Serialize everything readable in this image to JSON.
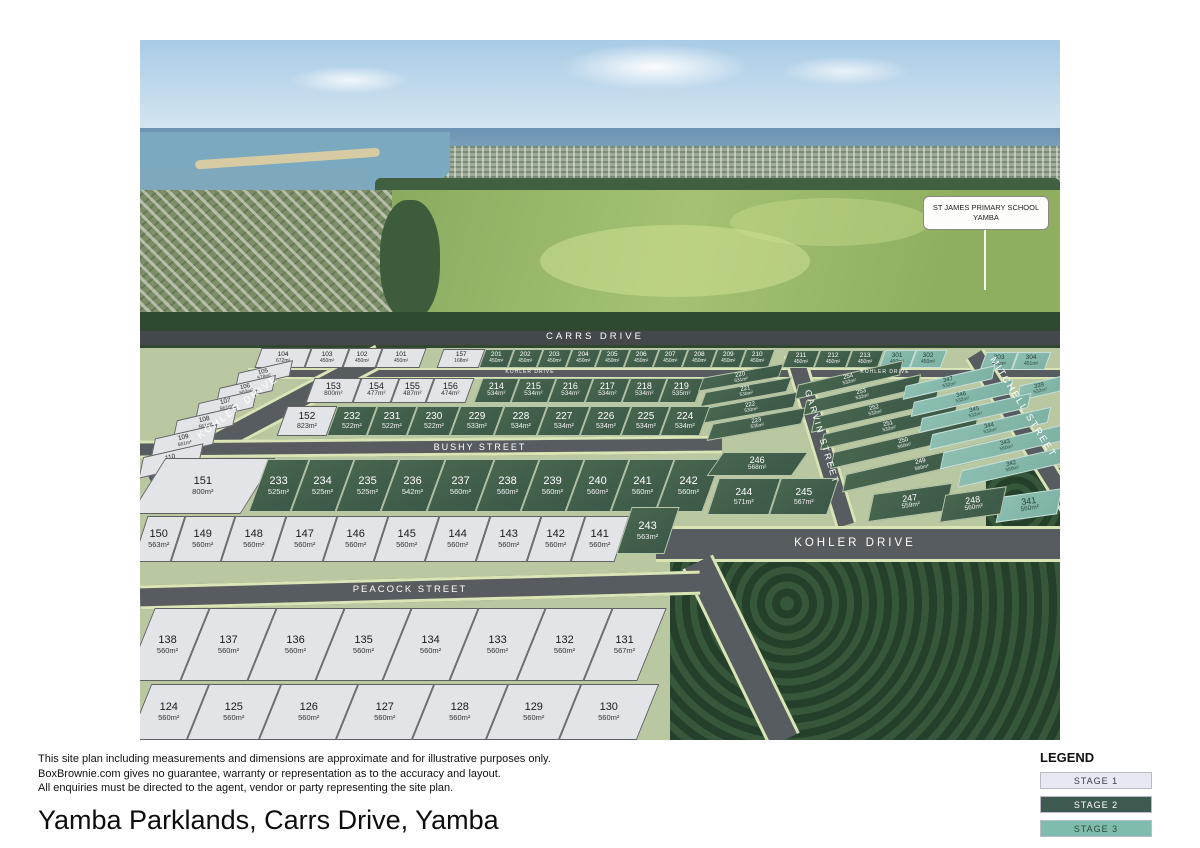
{
  "page": {
    "title": "Yamba Parklands, Carrs Drive, Yamba",
    "disclaimer": [
      "This site plan including measurements and dimensions are approximate and for illustrative purposes only.",
      "BoxBrownie.com gives no guarantee, warranty or representation as to the accuracy and layout.",
      "All enquiries must be directed to the agent, vendor or party representing the site plan."
    ]
  },
  "sign": {
    "line1": "ST JAMES PRIMARY SCHOOL",
    "line2": "YAMBA"
  },
  "streets": {
    "carrs": "CARRS DRIVE",
    "kohler_small_1": "KOHLER DRIVE",
    "kohler_small_2": "KOHLER DRIVE",
    "kohler_left": "KOHLER DRIVE",
    "kohler_main": "KOHLER DRIVE",
    "bushy": "BUSHY STREET",
    "peacock": "PEACOCK STREET",
    "garvin": "GARVIN STREET",
    "mitchell": "MITCHELL STREET"
  },
  "legend": {
    "title": "LEGEND",
    "items": [
      {
        "label": "STAGE 1",
        "color": "#e7e8f1",
        "text_color": "#3c3c44"
      },
      {
        "label": "STAGE 2",
        "color": "#3e5a50",
        "text_color": "#ffffff"
      },
      {
        "label": "STAGE 3",
        "color": "#7fbcae",
        "text_color": "#2c4a42"
      }
    ]
  },
  "stage_colors": {
    "stage1": "#e3e4e8",
    "stage2": "#42604e",
    "stage3": "#85b9ac"
  },
  "lots": [
    {
      "n": "104",
      "a": "672m²",
      "s": 1
    },
    {
      "n": "103",
      "a": "450m²",
      "s": 1
    },
    {
      "n": "102",
      "a": "450m²",
      "s": 1
    },
    {
      "n": "101",
      "a": "450m²",
      "s": 1
    },
    {
      "n": "157",
      "a": "168m²",
      "s": 1
    },
    {
      "n": "201",
      "a": "450m²",
      "s": 2
    },
    {
      "n": "202",
      "a": "450m²",
      "s": 2
    },
    {
      "n": "203",
      "a": "450m²",
      "s": 2
    },
    {
      "n": "204",
      "a": "450m²",
      "s": 2
    },
    {
      "n": "205",
      "a": "450m²",
      "s": 2
    },
    {
      "n": "206",
      "a": "450m²",
      "s": 2
    },
    {
      "n": "207",
      "a": "450m²",
      "s": 2
    },
    {
      "n": "208",
      "a": "450m²",
      "s": 2
    },
    {
      "n": "209",
      "a": "450m²",
      "s": 2
    },
    {
      "n": "210",
      "a": "450m²",
      "s": 2
    },
    {
      "n": "211",
      "a": "450m²",
      "s": 2
    },
    {
      "n": "212",
      "a": "450m²",
      "s": 2
    },
    {
      "n": "213",
      "a": "450m²",
      "s": 2
    },
    {
      "n": "301",
      "a": "450m²",
      "s": 3
    },
    {
      "n": "302",
      "a": "450m²",
      "s": 3
    },
    {
      "n": "303",
      "a": "451m²",
      "s": 3
    },
    {
      "n": "304",
      "a": "451m²",
      "s": 3
    },
    {
      "n": "339",
      "a": "532m²",
      "s": 3
    },
    {
      "n": "105",
      "a": "578m²",
      "s": 1
    },
    {
      "n": "106",
      "a": "563m²",
      "s": 1
    },
    {
      "n": "107",
      "a": "561m²",
      "s": 1
    },
    {
      "n": "108",
      "a": "561m²",
      "s": 1
    },
    {
      "n": "109",
      "a": "561m²",
      "s": 1
    },
    {
      "n": "110",
      "a": "561m²",
      "s": 1
    },
    {
      "n": "153",
      "a": "800m²",
      "s": 1
    },
    {
      "n": "154",
      "a": "477m²",
      "s": 1
    },
    {
      "n": "155",
      "a": "487m²",
      "s": 1
    },
    {
      "n": "156",
      "a": "474m²",
      "s": 1
    },
    {
      "n": "214",
      "a": "534m²",
      "s": 2
    },
    {
      "n": "215",
      "a": "534m²",
      "s": 2
    },
    {
      "n": "216",
      "a": "534m²",
      "s": 2
    },
    {
      "n": "217",
      "a": "534m²",
      "s": 2
    },
    {
      "n": "218",
      "a": "534m²",
      "s": 2
    },
    {
      "n": "219",
      "a": "535m²",
      "s": 2
    },
    {
      "n": "220",
      "a": "631m²",
      "s": 2
    },
    {
      "n": "221",
      "a": "530m²",
      "s": 2
    },
    {
      "n": "222",
      "a": "530m²",
      "s": 2
    },
    {
      "n": "223",
      "a": "535m²",
      "s": 2
    },
    {
      "n": "152",
      "a": "823m²",
      "s": 1
    },
    {
      "n": "232",
      "a": "522m²",
      "s": 2
    },
    {
      "n": "231",
      "a": "522m²",
      "s": 2
    },
    {
      "n": "230",
      "a": "522m²",
      "s": 2
    },
    {
      "n": "229",
      "a": "533m²",
      "s": 2
    },
    {
      "n": "228",
      "a": "534m²",
      "s": 2
    },
    {
      "n": "227",
      "a": "534m²",
      "s": 2
    },
    {
      "n": "226",
      "a": "534m²",
      "s": 2
    },
    {
      "n": "225",
      "a": "534m²",
      "s": 2
    },
    {
      "n": "224",
      "a": "534m²",
      "s": 2
    },
    {
      "n": "254",
      "a": "532m²",
      "s": 2
    },
    {
      "n": "253",
      "a": "532m²",
      "s": 2
    },
    {
      "n": "252",
      "a": "532m²",
      "s": 2
    },
    {
      "n": "251",
      "a": "532m²",
      "s": 2
    },
    {
      "n": "250",
      "a": "560m²",
      "s": 2
    },
    {
      "n": "249",
      "a": "560m²",
      "s": 2
    },
    {
      "n": "347",
      "a": "532m²",
      "s": 3
    },
    {
      "n": "346",
      "a": "532m²",
      "s": 3
    },
    {
      "n": "345",
      "a": "532m²",
      "s": 3
    },
    {
      "n": "344",
      "a": "532m²",
      "s": 3
    },
    {
      "n": "343",
      "a": "560m²",
      "s": 3
    },
    {
      "n": "342",
      "a": "560m²",
      "s": 3
    },
    {
      "n": "341",
      "a": "560m²",
      "s": 3
    },
    {
      "n": "151",
      "a": "800m²",
      "s": 1
    },
    {
      "n": "233",
      "a": "525m²",
      "s": 2
    },
    {
      "n": "234",
      "a": "525m²",
      "s": 2
    },
    {
      "n": "235",
      "a": "525m²",
      "s": 2
    },
    {
      "n": "236",
      "a": "542m²",
      "s": 2
    },
    {
      "n": "237",
      "a": "560m²",
      "s": 2
    },
    {
      "n": "238",
      "a": "560m²",
      "s": 2
    },
    {
      "n": "239",
      "a": "560m²",
      "s": 2
    },
    {
      "n": "240",
      "a": "560m²",
      "s": 2
    },
    {
      "n": "241",
      "a": "560m²",
      "s": 2
    },
    {
      "n": "242",
      "a": "560m²",
      "s": 2
    },
    {
      "n": "246",
      "a": "568m²",
      "s": 2
    },
    {
      "n": "244",
      "a": "571m²",
      "s": 2
    },
    {
      "n": "245",
      "a": "567m²",
      "s": 2
    },
    {
      "n": "247",
      "a": "559m²",
      "s": 2
    },
    {
      "n": "248",
      "a": "560m²",
      "s": 2
    },
    {
      "n": "150",
      "a": "563m²",
      "s": 1
    },
    {
      "n": "149",
      "a": "560m²",
      "s": 1
    },
    {
      "n": "148",
      "a": "560m²",
      "s": 1
    },
    {
      "n": "147",
      "a": "560m²",
      "s": 1
    },
    {
      "n": "146",
      "a": "560m²",
      "s": 1
    },
    {
      "n": "145",
      "a": "560m²",
      "s": 1
    },
    {
      "n": "144",
      "a": "560m²",
      "s": 1
    },
    {
      "n": "143",
      "a": "560m²",
      "s": 1
    },
    {
      "n": "142",
      "a": "560m²",
      "s": 1
    },
    {
      "n": "141",
      "a": "560m²",
      "s": 1
    },
    {
      "n": "243",
      "a": "563m²",
      "s": 2
    },
    {
      "n": "138",
      "a": "560m²",
      "s": 1
    },
    {
      "n": "137",
      "a": "560m²",
      "s": 1
    },
    {
      "n": "136",
      "a": "560m²",
      "s": 1
    },
    {
      "n": "135",
      "a": "560m²",
      "s": 1
    },
    {
      "n": "134",
      "a": "560m²",
      "s": 1
    },
    {
      "n": "133",
      "a": "560m²",
      "s": 1
    },
    {
      "n": "132",
      "a": "560m²",
      "s": 1
    },
    {
      "n": "131",
      "a": "567m²",
      "s": 1
    },
    {
      "n": "124",
      "a": "560m²",
      "s": 1
    },
    {
      "n": "125",
      "a": "560m²",
      "s": 1
    },
    {
      "n": "126",
      "a": "560m²",
      "s": 1
    },
    {
      "n": "127",
      "a": "560m²",
      "s": 1
    },
    {
      "n": "128",
      "a": "560m²",
      "s": 1
    },
    {
      "n": "129",
      "a": "560m²",
      "s": 1
    },
    {
      "n": "130",
      "a": "560m²",
      "s": 1
    }
  ]
}
